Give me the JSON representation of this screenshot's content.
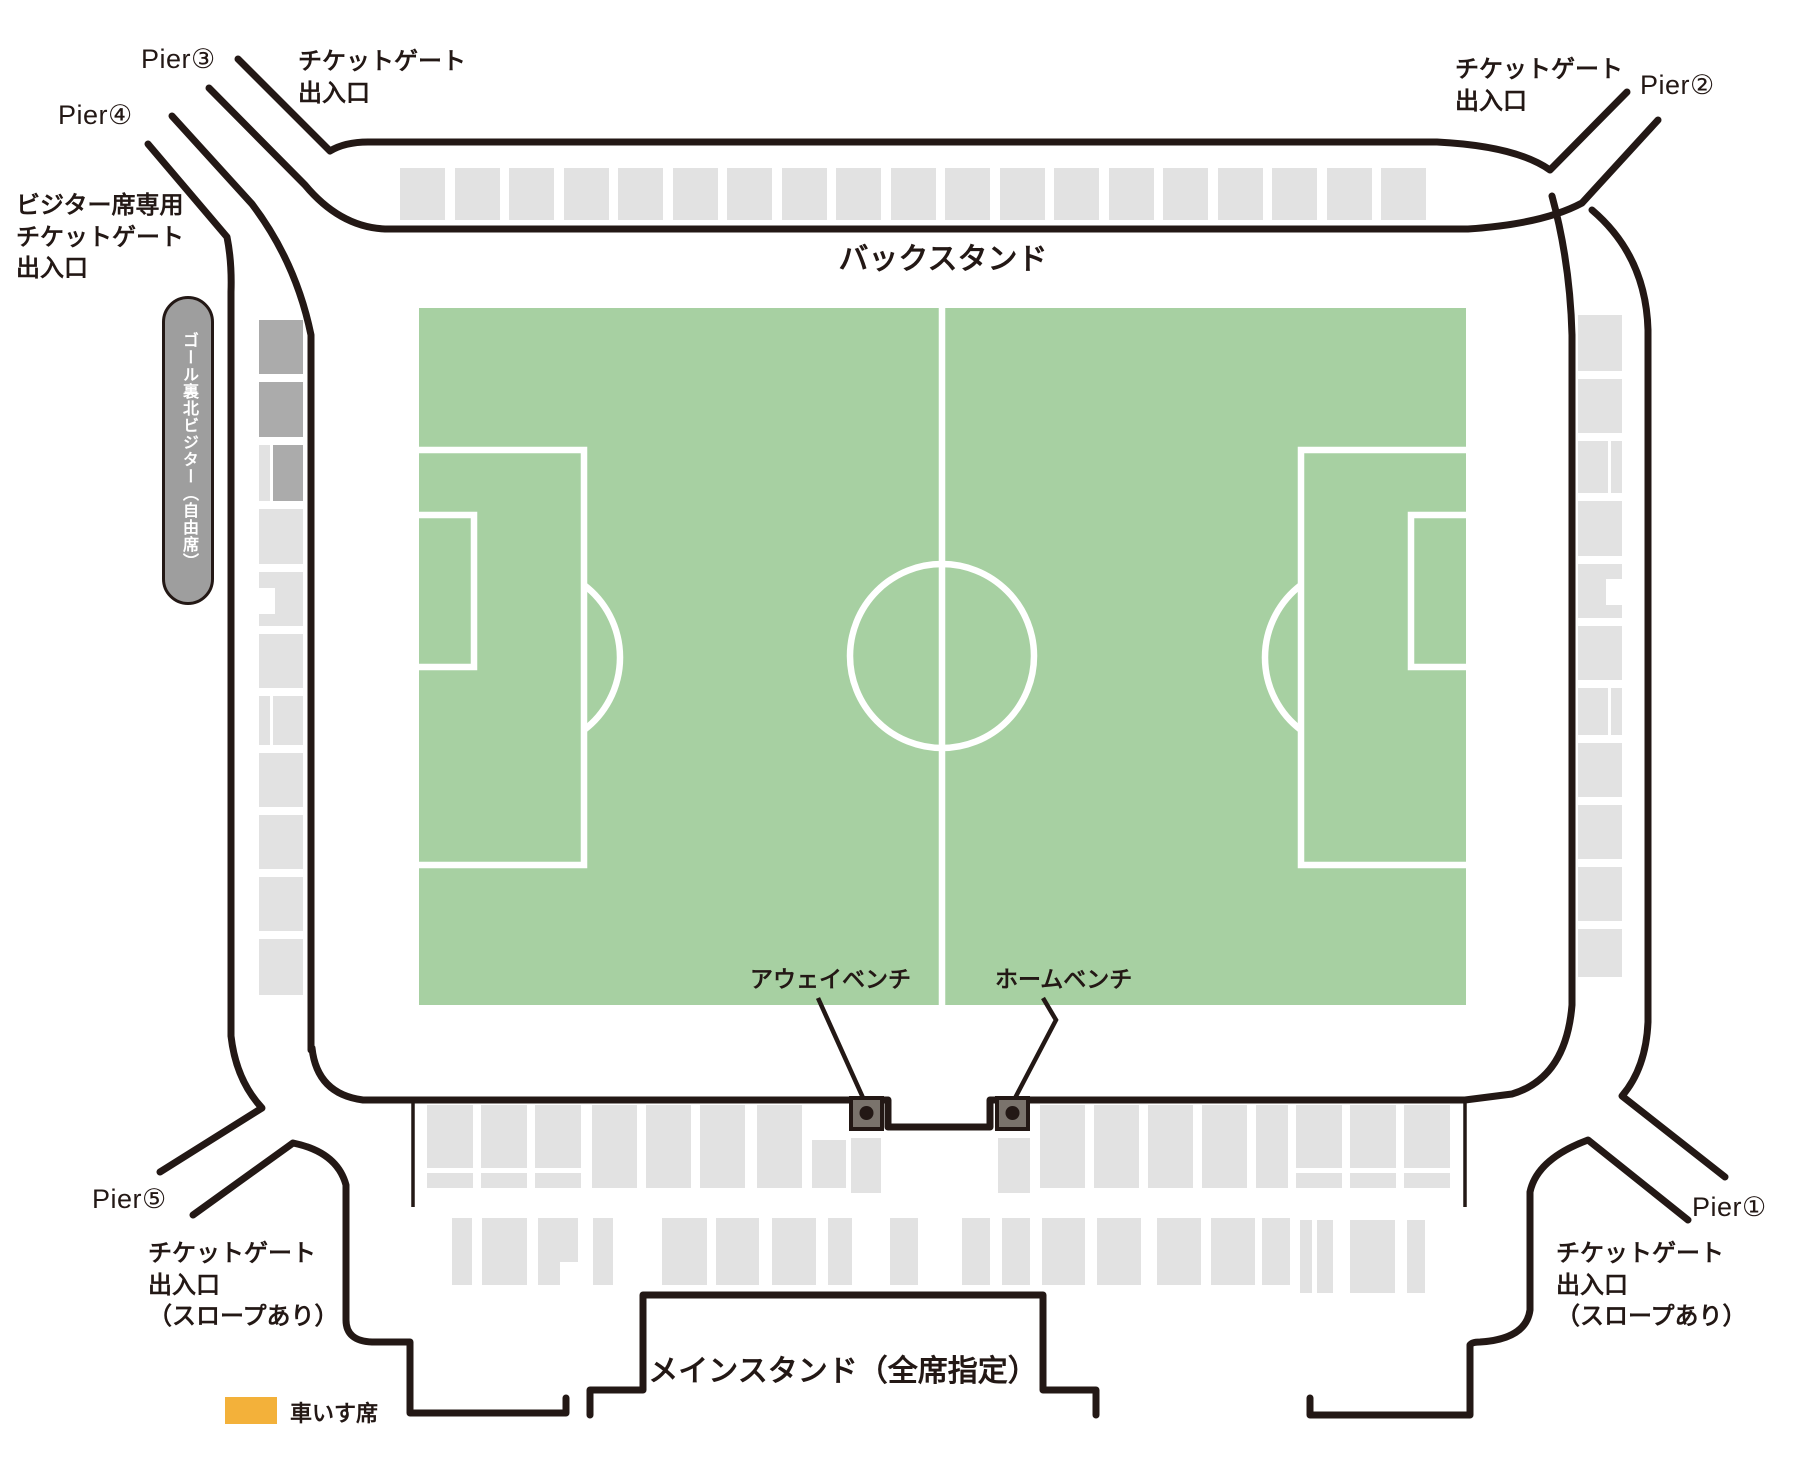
{
  "colors": {
    "pitch": "#a7d0a2",
    "seat_light": "#e2e2e2",
    "seat_dark": "#ababab",
    "wall": "#231815",
    "bench_fill": "#7a736c",
    "pill_bg": "#9e9e9e",
    "pill_text": "#ffffff",
    "wheelchair": "#f3b13a",
    "text": "#231815",
    "line_white": "#ffffff"
  },
  "stands": {
    "back": "バックスタンド",
    "main": "メインスタンド（全席指定）"
  },
  "benches": {
    "away": "アウェイベンチ",
    "home": "ホームベンチ"
  },
  "piers": {
    "p1": "Pier①",
    "p2": "Pier②",
    "p3": "Pier③",
    "p4": "Pier④",
    "p5": "Pier⑤"
  },
  "gates": {
    "top_left": "チケットゲート\n出入口",
    "top_right": "チケットゲート\n出入口",
    "visitor": "ビジター席専用\nチケットゲート\n出入口",
    "bottom_left": "チケットゲート\n出入口\n（スロープあり）",
    "bottom_right": "チケットゲート\n出入口\n（スロープあり）"
  },
  "visitor_section": "ゴール裏北ビジター（自由席）",
  "legend": {
    "wheelchair": "車いす席"
  }
}
